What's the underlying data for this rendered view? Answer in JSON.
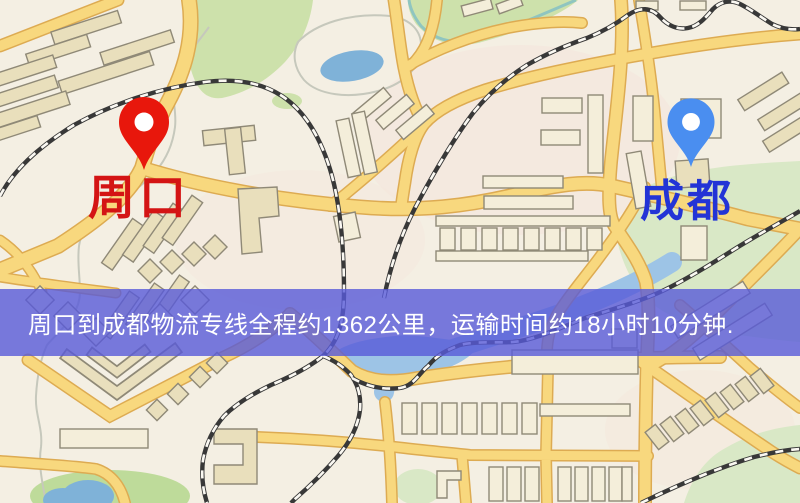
{
  "page": {
    "width": 800,
    "height": 503,
    "kind": "logistics-route-map-image"
  },
  "banner": {
    "text": "周口到成都物流专线全程约1362公里，运输时间约18小时10分钟.",
    "bg_color": "#585ad8",
    "text_color": "#ffffff"
  },
  "markers": {
    "origin": {
      "label": "周口",
      "pin_color": "#e8170c",
      "label_color": "#d41414",
      "icon": "map-pin-icon"
    },
    "destination": {
      "label": "成都",
      "pin_color": "#4a8ef0",
      "label_color": "#2334d6",
      "icon": "map-pin-icon"
    }
  },
  "route": {
    "distance_km": "1362",
    "duration": "18小时10分钟"
  },
  "map": {
    "colors": {
      "background": "#f4efe3",
      "road_fill": "#f8d87e",
      "road_casing": "#ddab52",
      "building_fill": "#e9dfbc",
      "building_light": "#f4eeda",
      "building_stroke": "#8f8977",
      "park_green": "#cde1ab",
      "pale_green": "#d9e8c6",
      "water_blue": "#7fb2d8",
      "river_blue": "#9dc4e6",
      "railway_dark": "#383838"
    }
  }
}
